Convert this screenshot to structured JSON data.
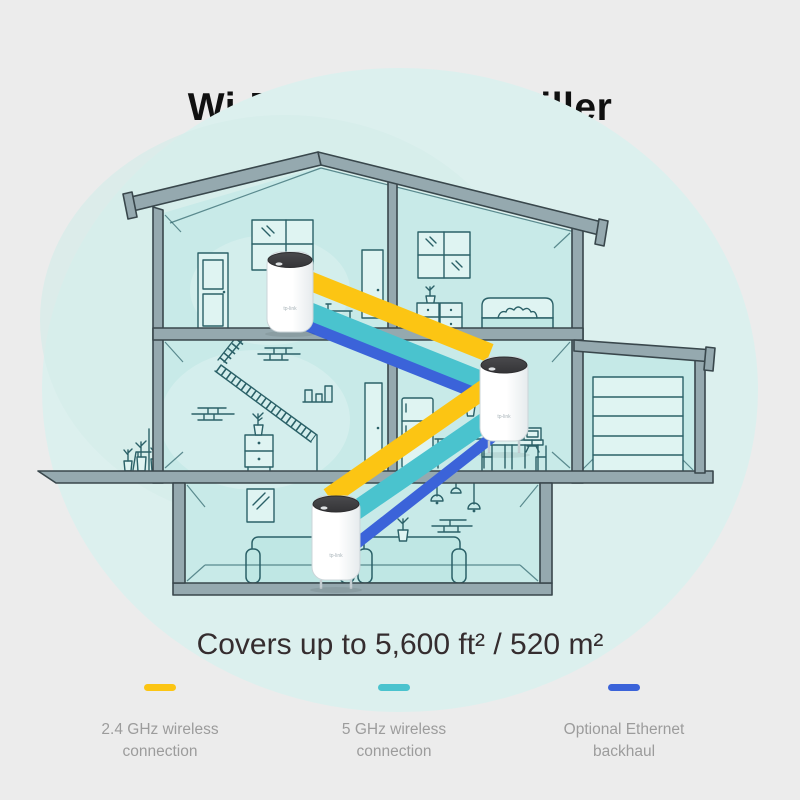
{
  "title": "Wi-Fi Dead Zone Killer",
  "coverage": "Covers up to 5,600 ft² / 520 m²",
  "legend": [
    {
      "id": "band-2-4ghz",
      "label_line1": "2.4 GHz wireless",
      "label_line2": "connection",
      "color": "#FCC513"
    },
    {
      "id": "band-5ghz",
      "label_line1": "5 GHz wireless",
      "label_line2": "connection",
      "color": "#4AC3CE"
    },
    {
      "id": "ethernet-backhaul",
      "label_line1": "Optional Ethernet",
      "label_line2": "backhaul",
      "color": "#3B63D9"
    }
  ],
  "device": {
    "logo": "tp-link",
    "count": 3
  },
  "colors": {
    "bg": "#ECECEC",
    "blob": "#DCF0EE",
    "blob_inner": "#D4EDEA",
    "room": "#C8EAE8",
    "room_alt": "#C5E9E7",
    "wall_fill": "#95A9AF",
    "wall_stroke": "#39474C",
    "line_art": "#2B6168",
    "window_fill": "#DFF4F2",
    "sofa_fill": "#BFE7E4",
    "deco_cap": "#3F3F41",
    "title_color": "#101010",
    "subtitle_color": "#352D2F",
    "legend_text": "#9C9C9C"
  }
}
